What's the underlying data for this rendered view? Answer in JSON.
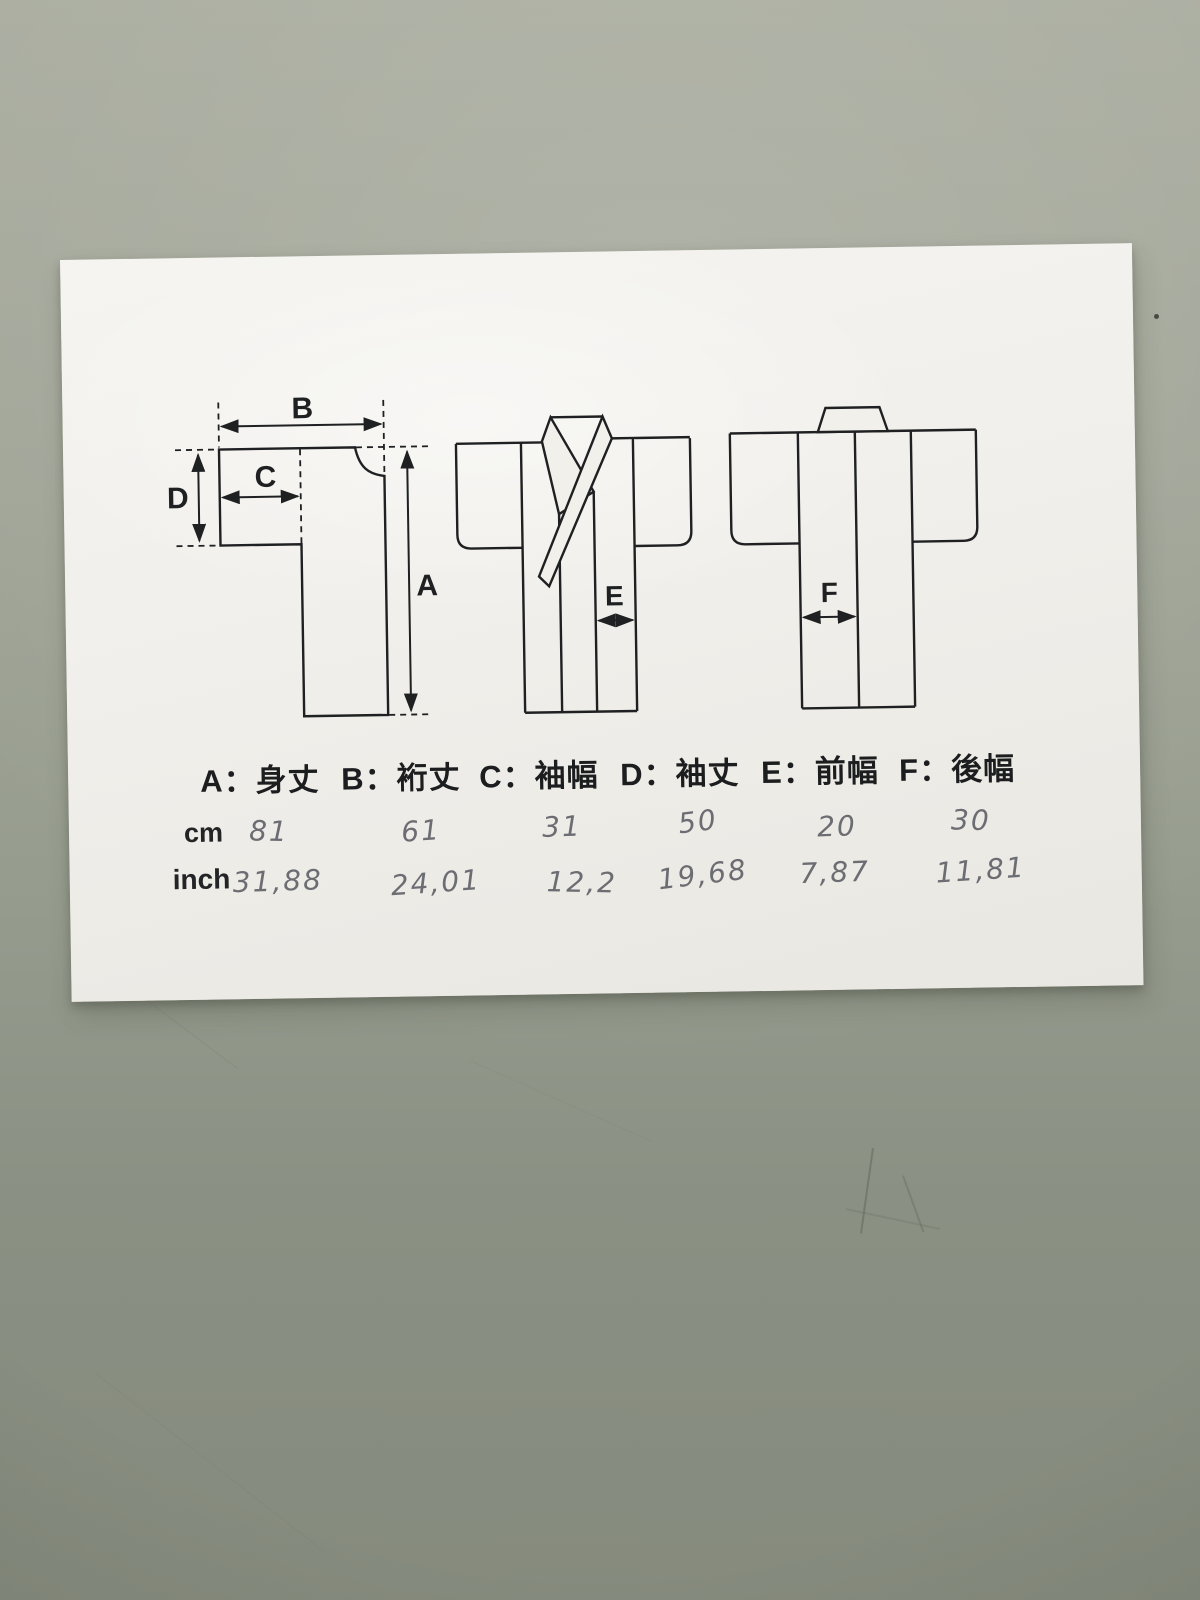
{
  "photo": {
    "table_color_top": "#abaea1",
    "table_color_bottom": "#7e8477",
    "paper_color": "#f2f0eb",
    "ink_color": "#1f2022",
    "pencil_color": "#50525a"
  },
  "document": {
    "separator": "：",
    "unit_row_cm": "cm",
    "unit_row_inch": "inch",
    "columns": [
      {
        "key": "A",
        "name": "身丈",
        "cm": "81",
        "inch": "31,88"
      },
      {
        "key": "B",
        "name": "裄丈",
        "cm": "61",
        "inch": "24,01"
      },
      {
        "key": "C",
        "name": "袖幅",
        "cm": "31",
        "inch": "12,2"
      },
      {
        "key": "D",
        "name": "袖丈",
        "cm": "50",
        "inch": "19,68"
      },
      {
        "key": "E",
        "name": "前幅",
        "cm": "20",
        "inch": "7,87"
      },
      {
        "key": "F",
        "name": "後幅",
        "cm": "30",
        "inch": "11,81"
      }
    ]
  }
}
